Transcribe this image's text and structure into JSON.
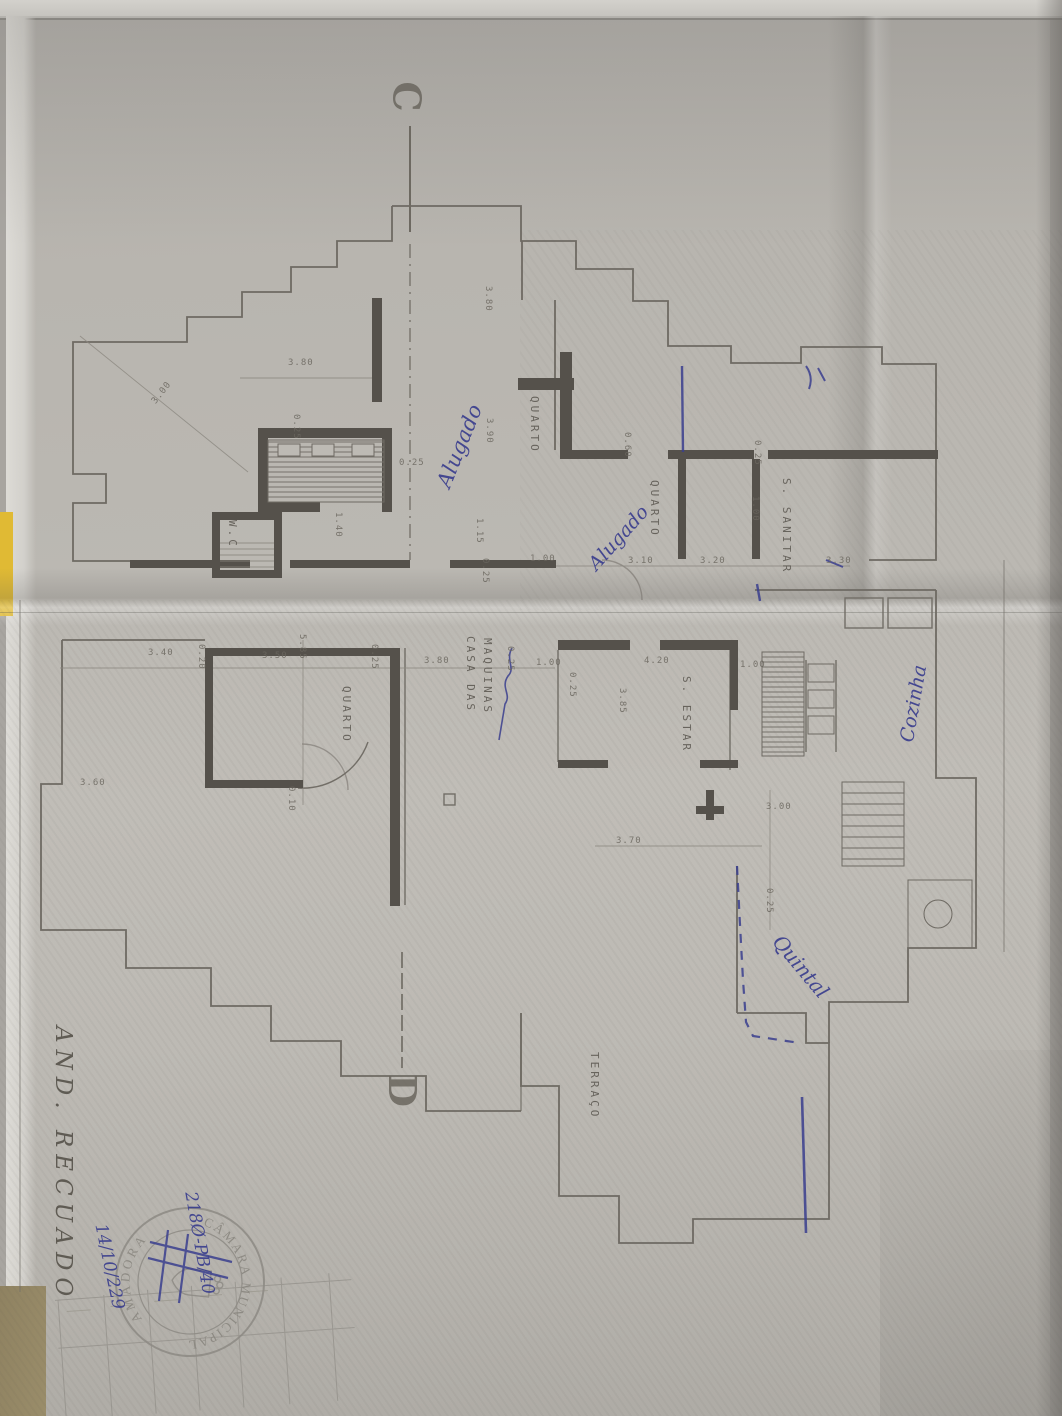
{
  "colors": {
    "ink_blue": "#3a3e8e",
    "paper_gray": "#bbb8b2",
    "line_gray": "#6e6a64",
    "wall_dark": "#55514b",
    "stamp_gray": "#8d8a84",
    "yellow_tab": "#e0ba34"
  },
  "title_block": {
    "title": "AND. RECUADO"
  },
  "stamp": {
    "ring_top": "CÂMARA MUNICIPAL",
    "ring_bottom": "AMADORA"
  },
  "plan": {
    "section_markers": [
      {
        "label": "C",
        "x": 392,
        "y": 74
      },
      {
        "label": "D",
        "x": 386,
        "y": 1068
      }
    ],
    "rooms": [
      {
        "t": "QUARTO",
        "x": 528,
        "y": 396
      },
      {
        "t": "QUARTO",
        "x": 648,
        "y": 480
      },
      {
        "t": "QUARTO",
        "x": 340,
        "y": 686
      },
      {
        "t": "W.C",
        "x": 226,
        "y": 520
      },
      {
        "t": "S. SANITAR",
        "x": 780,
        "y": 478
      },
      {
        "t": "CASA DAS",
        "x": 464,
        "y": 636
      },
      {
        "t": "MAQUINAS",
        "x": 481,
        "y": 638
      },
      {
        "t": "S. ESTAR",
        "x": 680,
        "y": 676
      },
      {
        "t": "TERRAÇO",
        "x": 588,
        "y": 1052
      }
    ],
    "dimensions": [
      {
        "t": "3.00",
        "x": 150,
        "y": 400,
        "o": "d",
        "a": -52
      },
      {
        "t": "3.80",
        "x": 288,
        "y": 358,
        "o": "h"
      },
      {
        "t": "0.25",
        "x": 291,
        "y": 414,
        "o": "v"
      },
      {
        "t": "3.80",
        "x": 483,
        "y": 286,
        "o": "v"
      },
      {
        "t": "3.90",
        "x": 484,
        "y": 418,
        "o": "v"
      },
      {
        "t": "0.25",
        "x": 399,
        "y": 458,
        "o": "h"
      },
      {
        "t": "1.15",
        "x": 474,
        "y": 518,
        "o": "v"
      },
      {
        "t": "0.25",
        "x": 480,
        "y": 558,
        "o": "v"
      },
      {
        "t": "1.00",
        "x": 530,
        "y": 554,
        "o": "h"
      },
      {
        "t": "1.40",
        "x": 333,
        "y": 512,
        "o": "v"
      },
      {
        "t": "0.60",
        "x": 622,
        "y": 432,
        "o": "v"
      },
      {
        "t": "0.25",
        "x": 752,
        "y": 440,
        "o": "v"
      },
      {
        "t": "1.00",
        "x": 750,
        "y": 496,
        "o": "v"
      },
      {
        "t": "3.10",
        "x": 628,
        "y": 556,
        "o": "h"
      },
      {
        "t": "3.20",
        "x": 700,
        "y": 556,
        "o": "h"
      },
      {
        "t": "3.30",
        "x": 826,
        "y": 556,
        "o": "h"
      },
      {
        "t": "3.40",
        "x": 148,
        "y": 648,
        "o": "h"
      },
      {
        "t": "0.20",
        "x": 196,
        "y": 644,
        "o": "v"
      },
      {
        "t": "3.50",
        "x": 262,
        "y": 651,
        "o": "h"
      },
      {
        "t": "5.85",
        "x": 297,
        "y": 634,
        "o": "v"
      },
      {
        "t": "0.25",
        "x": 369,
        "y": 644,
        "o": "v"
      },
      {
        "t": "3.80",
        "x": 424,
        "y": 656,
        "o": "h"
      },
      {
        "t": "0.25",
        "x": 505,
        "y": 646,
        "o": "v"
      },
      {
        "t": "1.00",
        "x": 536,
        "y": 658,
        "o": "h"
      },
      {
        "t": "0.25",
        "x": 567,
        "y": 672,
        "o": "v"
      },
      {
        "t": "4.20",
        "x": 644,
        "y": 656,
        "o": "h"
      },
      {
        "t": "1.00",
        "x": 740,
        "y": 660,
        "o": "h"
      },
      {
        "t": "3.85",
        "x": 617,
        "y": 688,
        "o": "v"
      },
      {
        "t": "3.60",
        "x": 80,
        "y": 778,
        "o": "h"
      },
      {
        "t": "0.10",
        "x": 286,
        "y": 786,
        "o": "v"
      },
      {
        "t": "3.70",
        "x": 616,
        "y": 836,
        "o": "h"
      },
      {
        "t": "3.00",
        "x": 766,
        "y": 802,
        "o": "h"
      },
      {
        "t": "0.25",
        "x": 764,
        "y": 888,
        "o": "v"
      }
    ]
  },
  "annotations": {
    "handwritten": [
      {
        "t": "Alugado",
        "x": 432,
        "y": 482,
        "a": -68,
        "s": 21
      },
      {
        "t": "Alugado",
        "x": 584,
        "y": 560,
        "a": -48,
        "s": 19
      },
      {
        "t": "Cozinha",
        "x": 896,
        "y": 740,
        "a": -80,
        "s": 19
      },
      {
        "t": "Quintal",
        "x": 786,
        "y": 930,
        "a": 50,
        "s": 20
      },
      {
        "t": "218Ø-PB/40",
        "x": 200,
        "y": 1190,
        "a": 80,
        "s": 17
      },
      {
        "t": "14/10/229",
        "x": 110,
        "y": 1222,
        "a": 78,
        "s": 17
      }
    ]
  }
}
